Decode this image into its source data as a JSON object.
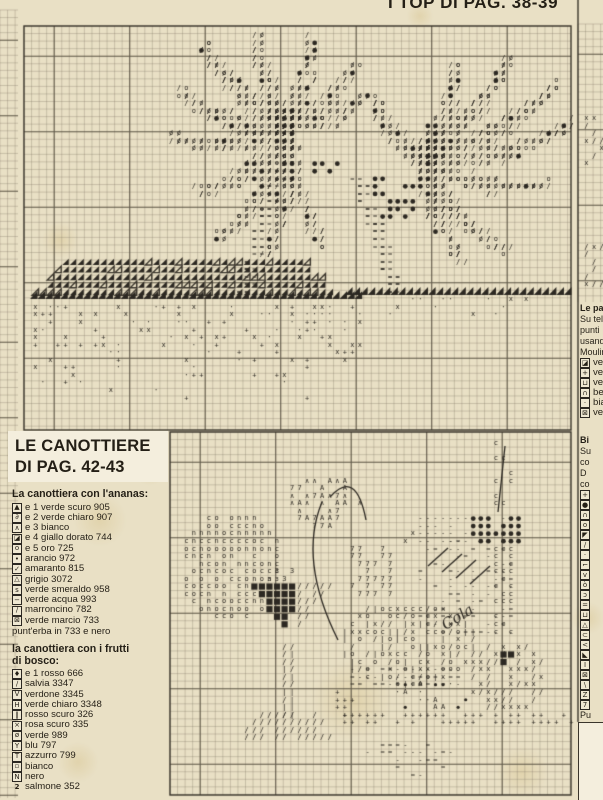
{
  "title_top_right": "I TOP DI PAG. 38-39",
  "heading_box": {
    "line1": "LE CANOTTIERE",
    "line2": "DI PAG. 42-43"
  },
  "legend_ananas": {
    "title": "La canottiera con l'ananas:",
    "items": [
      {
        "s": "▲",
        "t": "e 1 verde scuro 905",
        "box": true
      },
      {
        "s": "∂",
        "t": "e 2 verde chiaro 907",
        "box": true
      },
      {
        "s": "∧",
        "t": "e 3 bianco",
        "box": true
      },
      {
        "s": "◪",
        "t": "e 4 giallo dorato 744",
        "box": true
      },
      {
        "s": "o",
        "t": "e 5 oro 725",
        "box": true
      },
      {
        "s": "•",
        "t": "arancio 972",
        "box": true
      },
      {
        "s": "✓",
        "t": "amaranto 815",
        "box": true
      },
      {
        "s": "△",
        "t": "grigio 3072",
        "box": true
      },
      {
        "s": "s",
        "t": "verde smeraldo 958",
        "box": true
      },
      {
        "s": "−",
        "t": "verde acqua 993",
        "box": true
      },
      {
        "s": "∕",
        "t": "marroncino 782",
        "box": true
      },
      {
        "s": "⊠",
        "t": "verde marcio 733",
        "box": true
      }
    ],
    "footer": "punt'erba in 733 e nero"
  },
  "legend_frutti": {
    "title_line1": "la canottiera con i frutti",
    "title_line2": "di bosco:",
    "items": [
      {
        "s": "♦",
        "t": "e 1 rosso 666",
        "box": true
      },
      {
        "s": "∕",
        "t": "salvia 3347",
        "box": true
      },
      {
        "s": "V",
        "t": "verdone 3345",
        "box": true
      },
      {
        "s": "H",
        "t": "verde chiaro 3348",
        "box": true
      },
      {
        "s": "‖",
        "t": "rosso scuro 326",
        "box": true
      },
      {
        "s": "×",
        "t": "rosa scuro 335",
        "box": true
      },
      {
        "s": "ø",
        "t": "verde 989",
        "box": true
      },
      {
        "s": "Y",
        "t": "blu 797",
        "box": true
      },
      {
        "s": "T",
        "t": "azzurro 799",
        "box": true
      },
      {
        "s": "▫",
        "t": "bianco",
        "box": true
      },
      {
        "s": "N",
        "t": "nero",
        "box": true
      },
      {
        "s": "2",
        "t": "salmone 352",
        "box": false
      }
    ]
  },
  "right_block1": {
    "lines": [
      "Le pa",
      "Su tele",
      "punti",
      "usand",
      "Moulin"
    ],
    "bold_first": true,
    "items": [
      {
        "s": "◪",
        "t": "verd"
      },
      {
        "s": "+",
        "t": "verd"
      },
      {
        "s": "⊔",
        "t": "verd"
      },
      {
        "s": "∩",
        "t": "beig"
      },
      {
        "s": "·",
        "t": "bian"
      },
      {
        "s": "⊠",
        "t": "verd"
      }
    ]
  },
  "right_block2": {
    "lines": [
      "Bi",
      "Su",
      "co",
      "D",
      "co"
    ],
    "items": [
      {
        "s": "+",
        "t": ""
      },
      {
        "s": "●",
        "t": ""
      },
      {
        "s": "∩",
        "t": ""
      },
      {
        "s": "o",
        "t": ""
      },
      {
        "s": "◤",
        "t": ""
      },
      {
        "s": "∕",
        "t": ""
      },
      {
        "s": "·",
        "t": ""
      },
      {
        "s": "⌐",
        "t": ""
      },
      {
        "s": "v",
        "t": ""
      },
      {
        "s": "ò",
        "t": ""
      },
      {
        "s": "ɔ",
        "t": ""
      },
      {
        "s": "=",
        "t": ""
      },
      {
        "s": "⊔",
        "t": ""
      },
      {
        "s": "△",
        "t": ""
      },
      {
        "s": "⊂",
        "t": ""
      },
      {
        "s": "<",
        "t": ""
      },
      {
        "s": "◣",
        "t": ""
      },
      {
        "s": "I",
        "t": ""
      },
      {
        "s": "⊠",
        "t": ""
      },
      {
        "s": "\\",
        "t": ""
      },
      {
        "s": "Z",
        "t": ""
      },
      {
        "s": "7",
        "t": ""
      }
    ],
    "tail": [
      "Pu",
      "ne"
    ]
  },
  "art": {
    "paper": "#e9e0c5",
    "ink": "#2c2822",
    "grid_minor": "rgba(122,112,94,0.5)",
    "grid_major": "rgba(84,76,62,0.85)",
    "cell": 7.55,
    "stains": [
      [
        100,
        520,
        26
      ],
      [
        352,
        700,
        40
      ],
      [
        78,
        762,
        20
      ],
      [
        588,
        618,
        16
      ],
      [
        420,
        16,
        13
      ],
      [
        150,
        470,
        15
      ],
      [
        522,
        772,
        26
      ],
      [
        60,
        240,
        18
      ]
    ],
    "grids": [
      [
        0,
        10,
        18,
        788
      ],
      [
        24,
        26,
        547,
        404
      ],
      [
        578,
        24,
        25,
        278
      ],
      [
        170,
        432,
        401,
        363
      ]
    ],
    "frames": [
      [
        24,
        26,
        547,
        404
      ],
      [
        170,
        432,
        401,
        363
      ]
    ],
    "vlines": [
      [
        578,
        0,
        722
      ]
    ],
    "white_tab": [
      578,
      722,
      25,
      78
    ],
    "palms": [
      {
        "crown": [
          282,
          118
        ],
        "fronds": [
          [
            200,
            38,
            -18
          ],
          [
            255,
            30,
            -10
          ],
          [
            310,
            36,
            12
          ],
          [
            352,
            60,
            22
          ],
          [
            176,
            86,
            -26
          ],
          [
            166,
            130,
            -30
          ],
          [
            190,
            185,
            -34
          ],
          [
            212,
            236,
            -30
          ],
          [
            262,
            252,
            -16
          ],
          [
            318,
            242,
            18
          ],
          [
            362,
            92,
            26
          ]
        ]
      },
      {
        "crown": [
          420,
          150
        ],
        "fronds": [
          [
            455,
            60,
            14
          ],
          [
            508,
            56,
            18
          ],
          [
            556,
            80,
            26
          ],
          [
            568,
            122,
            30
          ],
          [
            546,
            182,
            32
          ],
          [
            504,
            250,
            30
          ],
          [
            456,
            258,
            18
          ],
          [
            372,
            92,
            -20
          ]
        ]
      }
    ],
    "coconuts": [
      [
        388,
        192,
        26,
        24,
        0.5
      ],
      [
        300,
        92,
        20,
        12,
        0.3
      ],
      [
        322,
        163,
        16,
        10,
        0.35
      ]
    ],
    "trunks": [
      [
        [
          275,
          160
        ],
        [
          258,
          212
        ],
        [
          243,
          264
        ],
        [
          238,
          292
        ]
      ],
      [
        [
          352,
          176
        ],
        [
          368,
          222
        ],
        [
          382,
          264
        ],
        [
          386,
          292
        ]
      ]
    ],
    "tri_rows": {
      "x0": 30,
      "x1": 332,
      "y0": 258,
      "rows": 5
    },
    "bands": [
      [
        30,
        362,
        291,
        8
      ],
      [
        345,
        569,
        287,
        8
      ]
    ],
    "scatters": [
      {
        "r": [
          30,
          300,
          330,
          92
        ],
        "g": [
          "x",
          "·",
          "+"
        ],
        "d": 0.42,
        "fade": 1
      },
      {
        "r": [
          362,
          298,
          205,
          20
        ],
        "g": [
          "x",
          "·"
        ],
        "d": 0.18,
        "fade": 1
      },
      {
        "r": [
          580,
          112,
          22,
          52
        ],
        "g": [
          "/",
          "x"
        ],
        "d": 0.5,
        "fade": 0
      },
      {
        "r": [
          580,
          238,
          22,
          46
        ],
        "g": [
          "/",
          "x"
        ],
        "d": 0.5,
        "fade": 0
      },
      {
        "r": [
          352,
          545,
          38,
          46
        ],
        "g": [
          "7"
        ],
        "d": 0.6,
        "fade": 0
      },
      {
        "r": [
          345,
          662,
          106,
          16
        ],
        "g": [
          "-",
          "="
        ],
        "d": 0.85,
        "fade": 0
      },
      {
        "r": [
          388,
          682,
          80,
          28
        ],
        "g": [
          "·",
          "•",
          "A"
        ],
        "d": 0.45,
        "fade": 0
      },
      {
        "r": [
          338,
          712,
          232,
          14
        ],
        "g": [
          "+"
        ],
        "d": 0.65,
        "fade": 0
      },
      {
        "r": [
          332,
          686,
          22,
          28
        ],
        "g": [
          "+"
        ],
        "d": 0.55,
        "fade": 0
      },
      {
        "r": [
          417,
          512,
          97,
          26
        ],
        "g": [
          "-"
        ],
        "d": 0.7,
        "fade": 0
      },
      {
        "r": [
          417,
          540,
          97,
          96
        ],
        "g": [
          "-",
          "="
        ],
        "d": 0.45,
        "fade": 0
      },
      {
        "r": [
          494,
          540,
          18,
          96
        ],
        "g": [
          "c"
        ],
        "d": 0.55,
        "fade": 0
      },
      {
        "r": [
          494,
          443,
          22,
          70
        ],
        "g": [
          "c"
        ],
        "d": 0.5,
        "fade": 0
      },
      {
        "r": [
          397,
          531,
          22,
          12
        ],
        "g": [
          "x"
        ],
        "d": 0.5,
        "fade": 0
      },
      {
        "r": [
          252,
          570,
          40,
          14
        ],
        "g": [
          "ɜ",
          "3"
        ],
        "d": 0.4,
        "fade": 0
      }
    ],
    "dotfields": [
      [
        468,
        512,
        46,
        24,
        0.85
      ]
    ],
    "blobs": [
      {
        "e": [
          224,
          560,
          52,
          55
        ],
        "g": [
          "o",
          "n",
          "c"
        ],
        "d": 0.82
      },
      {
        "e": [
          205,
          545,
          18,
          15
        ],
        "g": [
          "●"
        ],
        "d": 0.25
      },
      {
        "e": [
          315,
          497,
          38,
          27
        ],
        "g": [
          "∧",
          "A",
          "7"
        ],
        "d": 0.75
      },
      {
        "e": [
          400,
          640,
          70,
          42
        ],
        "g": [
          "x",
          "/",
          "c",
          "|",
          "o"
        ],
        "d": 0.75
      },
      {
        "e": [
          505,
          673,
          40,
          37
        ],
        "g": [
          "x",
          "/"
        ],
        "d": 0.7
      },
      {
        "e": [
          403,
          757,
          50,
          22
        ],
        "g": [
          "-",
          "="
        ],
        "d": 0.42
      },
      {
        "e": [
          503,
          653,
          10,
          8
        ],
        "g": [
          "#"
        ],
        "d": 0.95
      }
    ],
    "polys": [
      {
        "p": [
          [
            250,
            585
          ],
          [
            292,
            585
          ],
          [
            284,
            638
          ]
        ],
        "g": [
          "#"
        ],
        "d": 0.9
      },
      {
        "p": [
          [
            292,
            585
          ],
          [
            324,
            585
          ],
          [
            286,
            638
          ]
        ],
        "g": [
          "/"
        ],
        "d": 0.9
      },
      {
        "p": [
          [
            279,
            640
          ],
          [
            287,
            640
          ],
          [
            287,
            714
          ],
          [
            279,
            714
          ]
        ],
        "g": [
          "|",
          "/"
        ],
        "d": 0.95
      },
      {
        "p": [
          [
            252,
            712
          ],
          [
            316,
            712
          ],
          [
            332,
            737
          ],
          [
            236,
            737
          ]
        ],
        "g": [
          "/"
        ],
        "d": 0.85
      }
    ],
    "strokes": [
      [
        [
          322,
          502
        ],
        [
          298,
          560
        ],
        [
          338,
          640
        ]
      ],
      [
        [
          505,
          446
        ],
        [
          498,
          512
        ]
      ],
      [
        [
          428,
          566
        ],
        [
          448,
          548
        ]
      ],
      [
        [
          442,
          572
        ],
        [
          462,
          554
        ]
      ],
      [
        [
          456,
          578
        ],
        [
          476,
          560
        ]
      ],
      [
        [
          470,
          584
        ],
        [
          490,
          566
        ]
      ],
      [
        [
          330,
          497
        ],
        [
          356,
          468
        ],
        [
          366,
          520
        ]
      ]
    ],
    "script": {
      "text": "Cola",
      "x": 458,
      "y": 618,
      "size": 15,
      "rot": -32
    }
  }
}
